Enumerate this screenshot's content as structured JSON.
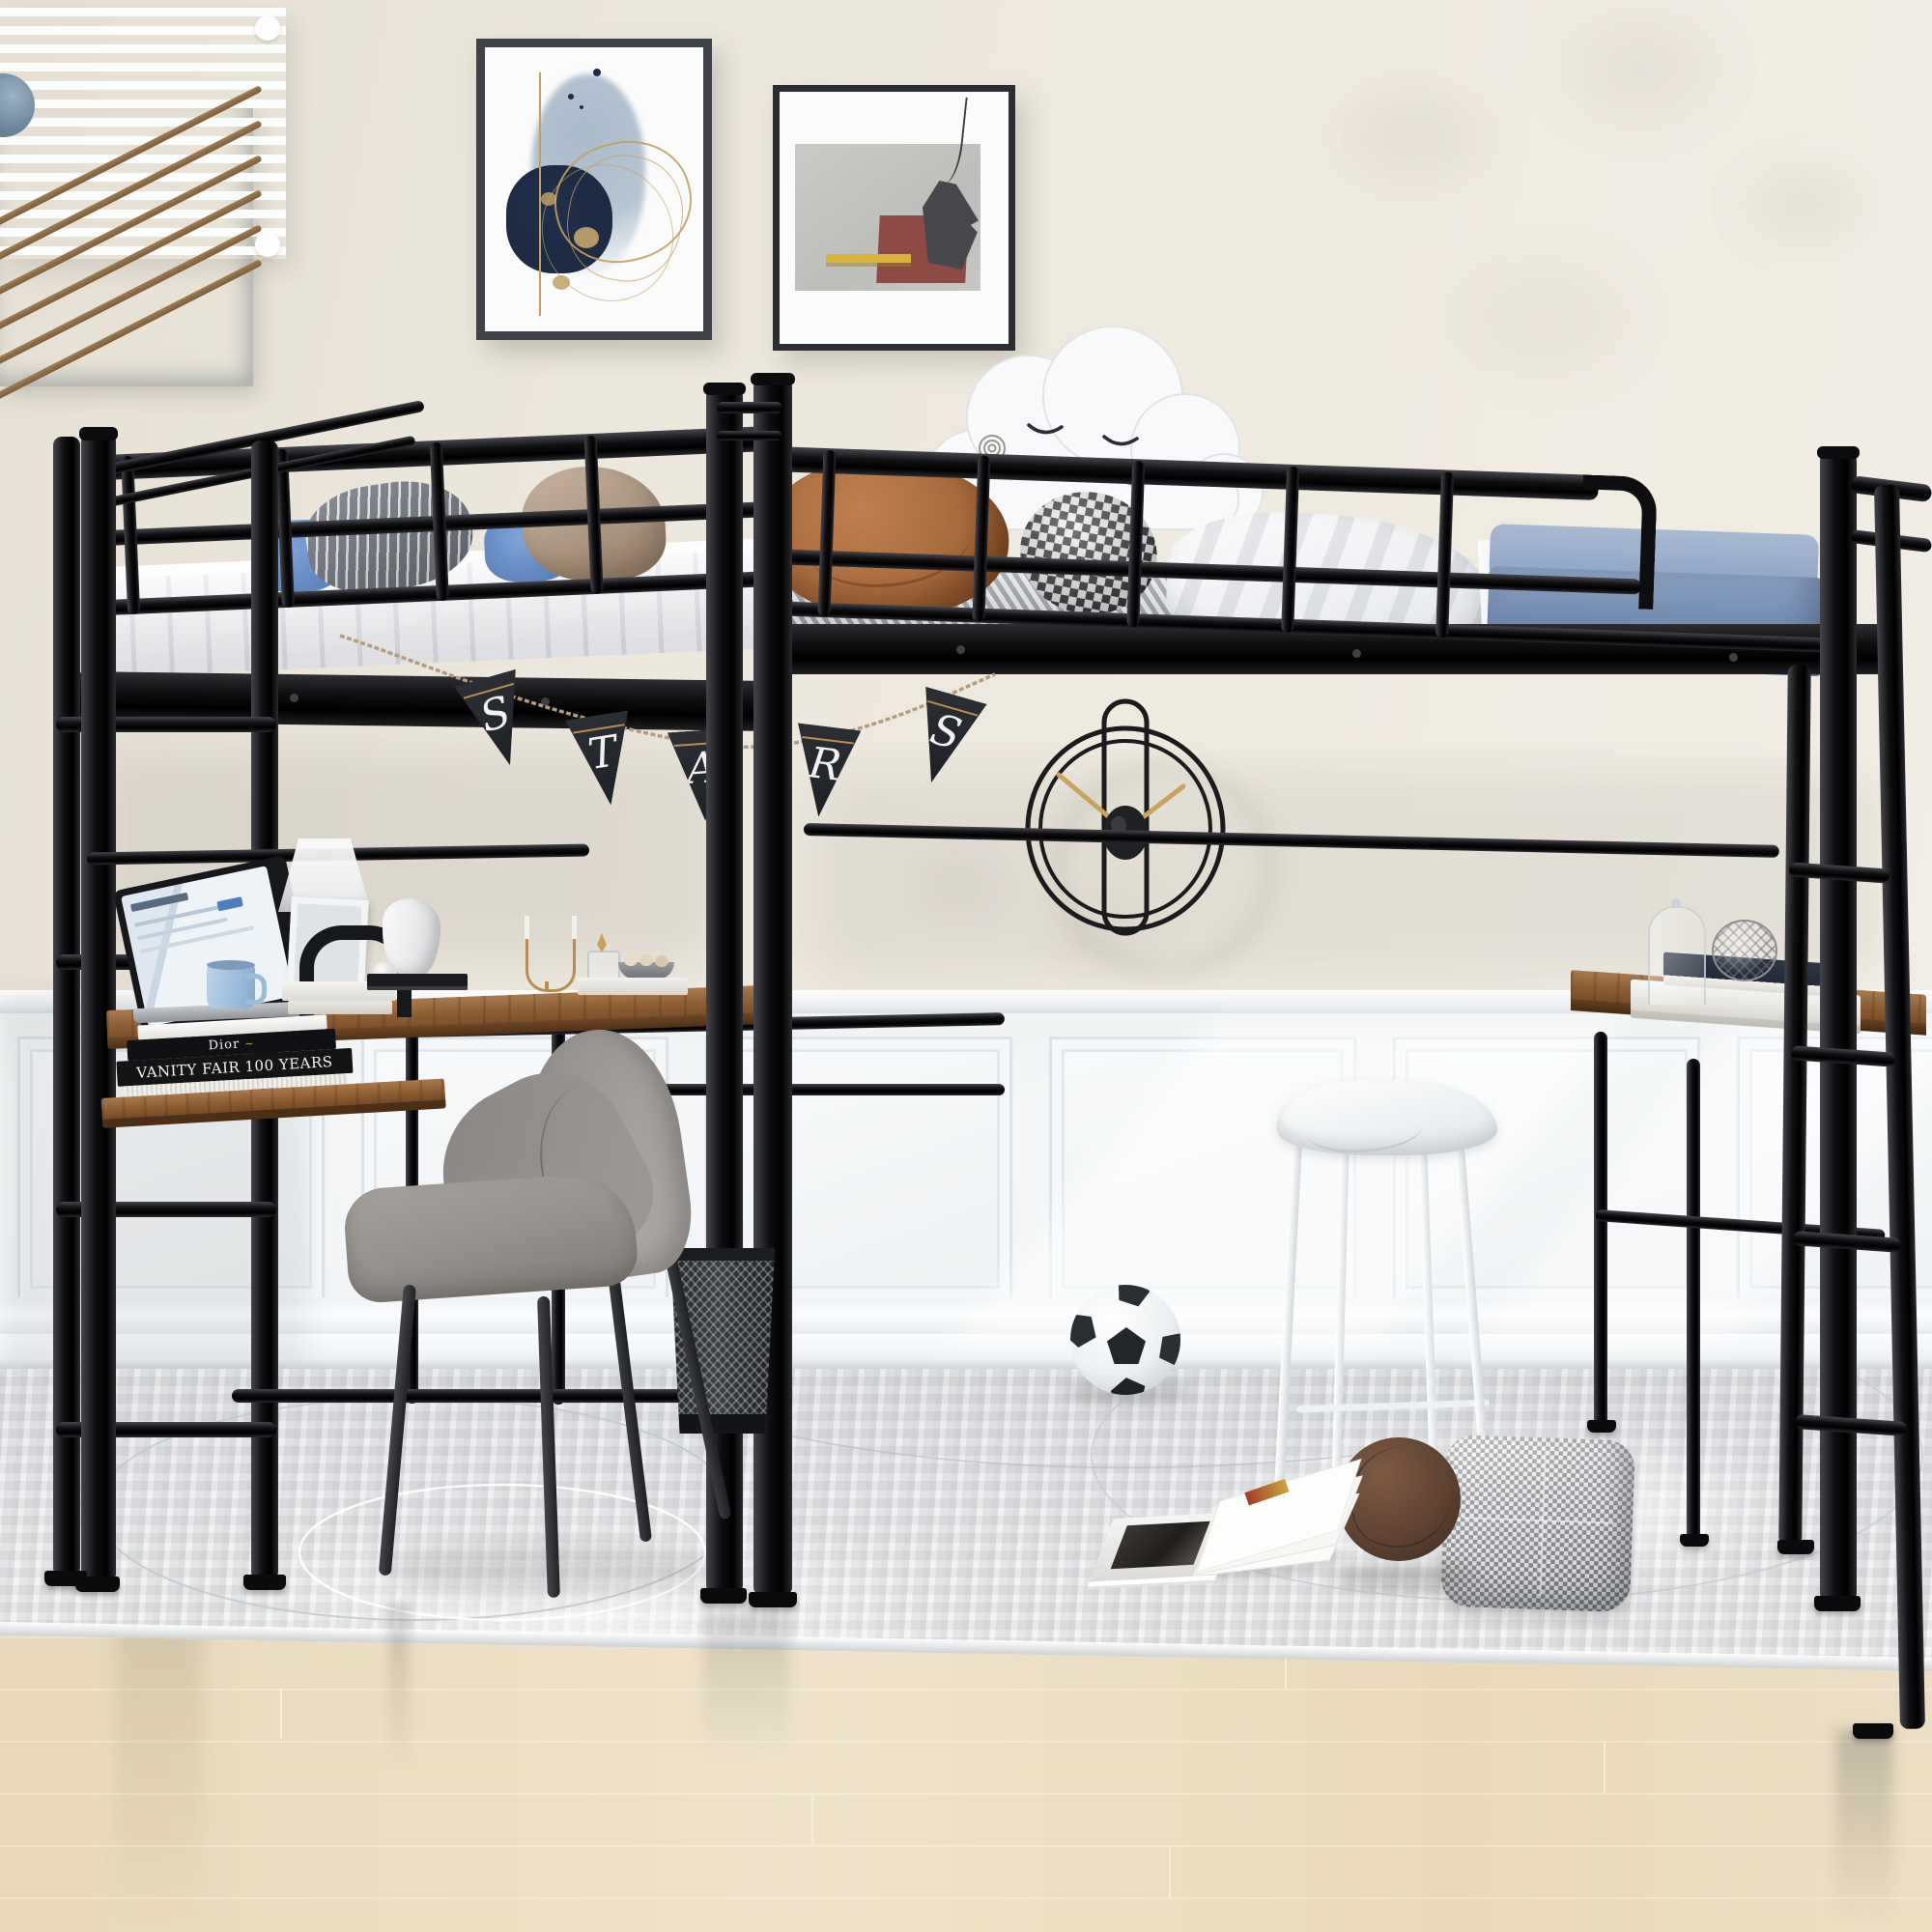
{
  "scene": {
    "type": "product-lifestyle-photo",
    "description": "Kids bedroom with an L-shaped black metal double twin loft bed; each loft has a desk underneath, ladders on both ends, staged with decor",
    "room": "bedroom with beige wall, white wainscoting, gray rug, light oak floor"
  },
  "banner": {
    "word": "STARS",
    "flags": [
      {
        "letter": "S"
      },
      {
        "letter": "T"
      },
      {
        "letter": "A"
      },
      {
        "letter": "R"
      },
      {
        "letter": "S"
      }
    ]
  },
  "books": {
    "black_spine": "VANITY FAIR 100 YEARS",
    "white_spine": "Dior"
  },
  "objects": [
    "slatted-wall-art",
    "abstract-painting-blue-gold",
    "abstract-painting-gray-red",
    "minimal-wire-wall-clock",
    "pennant-banner",
    "cloud-pillow",
    "left-loft-bed",
    "right-loft-bed",
    "left-ladder",
    "right-ladder",
    "left-desk",
    "right-desk",
    "laptop",
    "mug",
    "desk-lamp",
    "picture-frame",
    "arch-sculpture",
    "bust-sculpture",
    "candelabra",
    "book-stacks",
    "gray-desk-chair",
    "mesh-wastebasket",
    "white-stool",
    "soccer-ball",
    "open-magazine",
    "plush-ball",
    "houndstooth-pillow",
    "glass-cloche",
    "wire-sphere"
  ],
  "palette": {
    "wall": "#ece7dd",
    "wainscot": "#f5f7f8",
    "rug": "#e3e4e6",
    "floor_wood": "#e9dabd",
    "metal_frame": "#0e0e10",
    "desk_wood": "#8f6239",
    "mattress_white": "#f5f5f7",
    "mattress_stripe_gray": "#9ba0a6",
    "bedding_blue": "#7e96bb",
    "pillow_blue": "#6d95cc",
    "pillow_caramel": "#a76a3d",
    "blanket_tan": "#b3a08c",
    "chair_gray": "#9a9692",
    "banner_flag": "#23262b",
    "banner_rope": "#b39b80",
    "clock_hands_gold": "#c9a35c",
    "painting_navy": "#1d2b45",
    "painting_maroon": "#8e4a45",
    "painting_gold": "#c2a061",
    "art_slat_blue": "#8ba0b0",
    "stick_brown": "#8a6a45"
  }
}
